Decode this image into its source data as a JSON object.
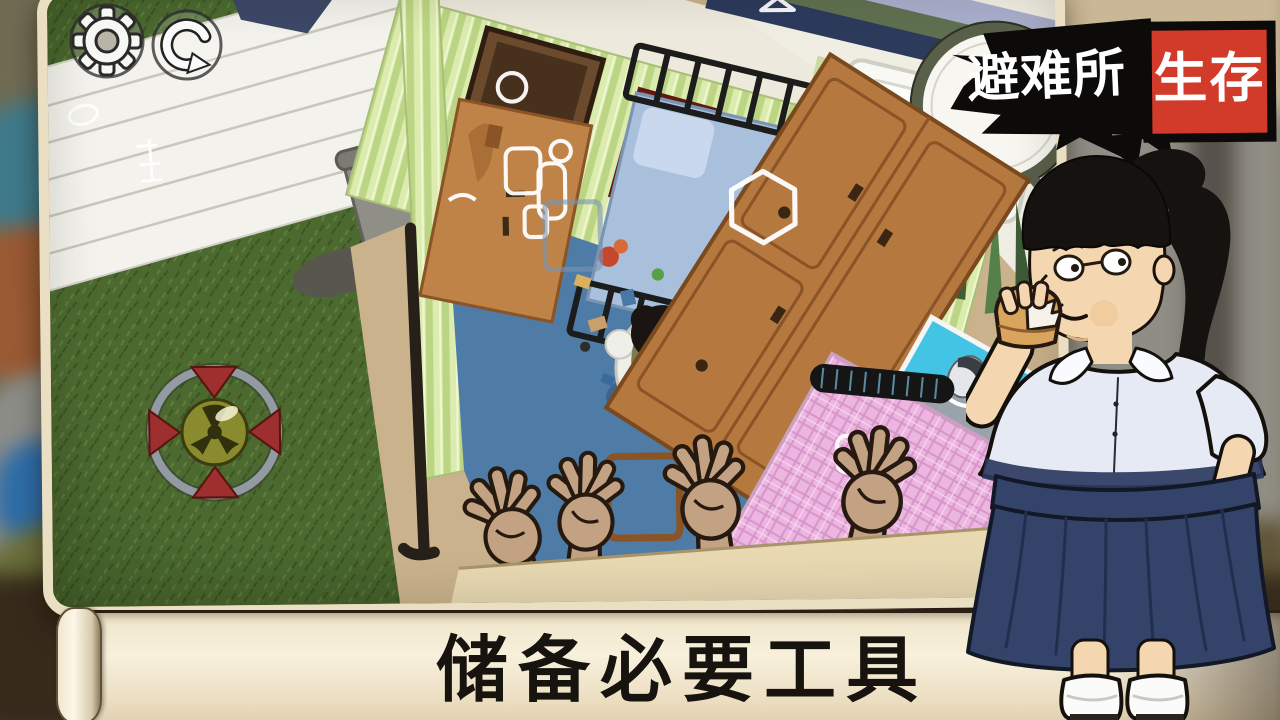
{
  "app": {
    "title": "避难所生存"
  },
  "logo": {
    "shelter": "避难所",
    "survival": "生存",
    "red": "#d23b2a",
    "black": "#0c0b09",
    "text_color": "#ffffff"
  },
  "hud": {
    "settings": {
      "icon": "gear-icon"
    },
    "restart": {
      "icon": "restart-arrow-icon"
    }
  },
  "banner": {
    "text": "储备必要工具",
    "paper_color": "#f3e9d1",
    "ink_color": "#17130e"
  },
  "scene": {
    "palette": {
      "grass": "#4c6a30",
      "room_floor_blue": "#4e7ca6",
      "wall_stripe_green": "#dcebae",
      "furniture_wood": "#b5793f",
      "bath_floor": "#f0ede2",
      "bed_pink": "#ecb6e0",
      "hatch_red": "#9e2f2f",
      "hatch_core_yellow": "#8a8a2e",
      "hint_outline": "#ffffff"
    }
  },
  "character": {
    "shirt_color": "#e6eaf4",
    "skirt_color": "#33436a"
  }
}
